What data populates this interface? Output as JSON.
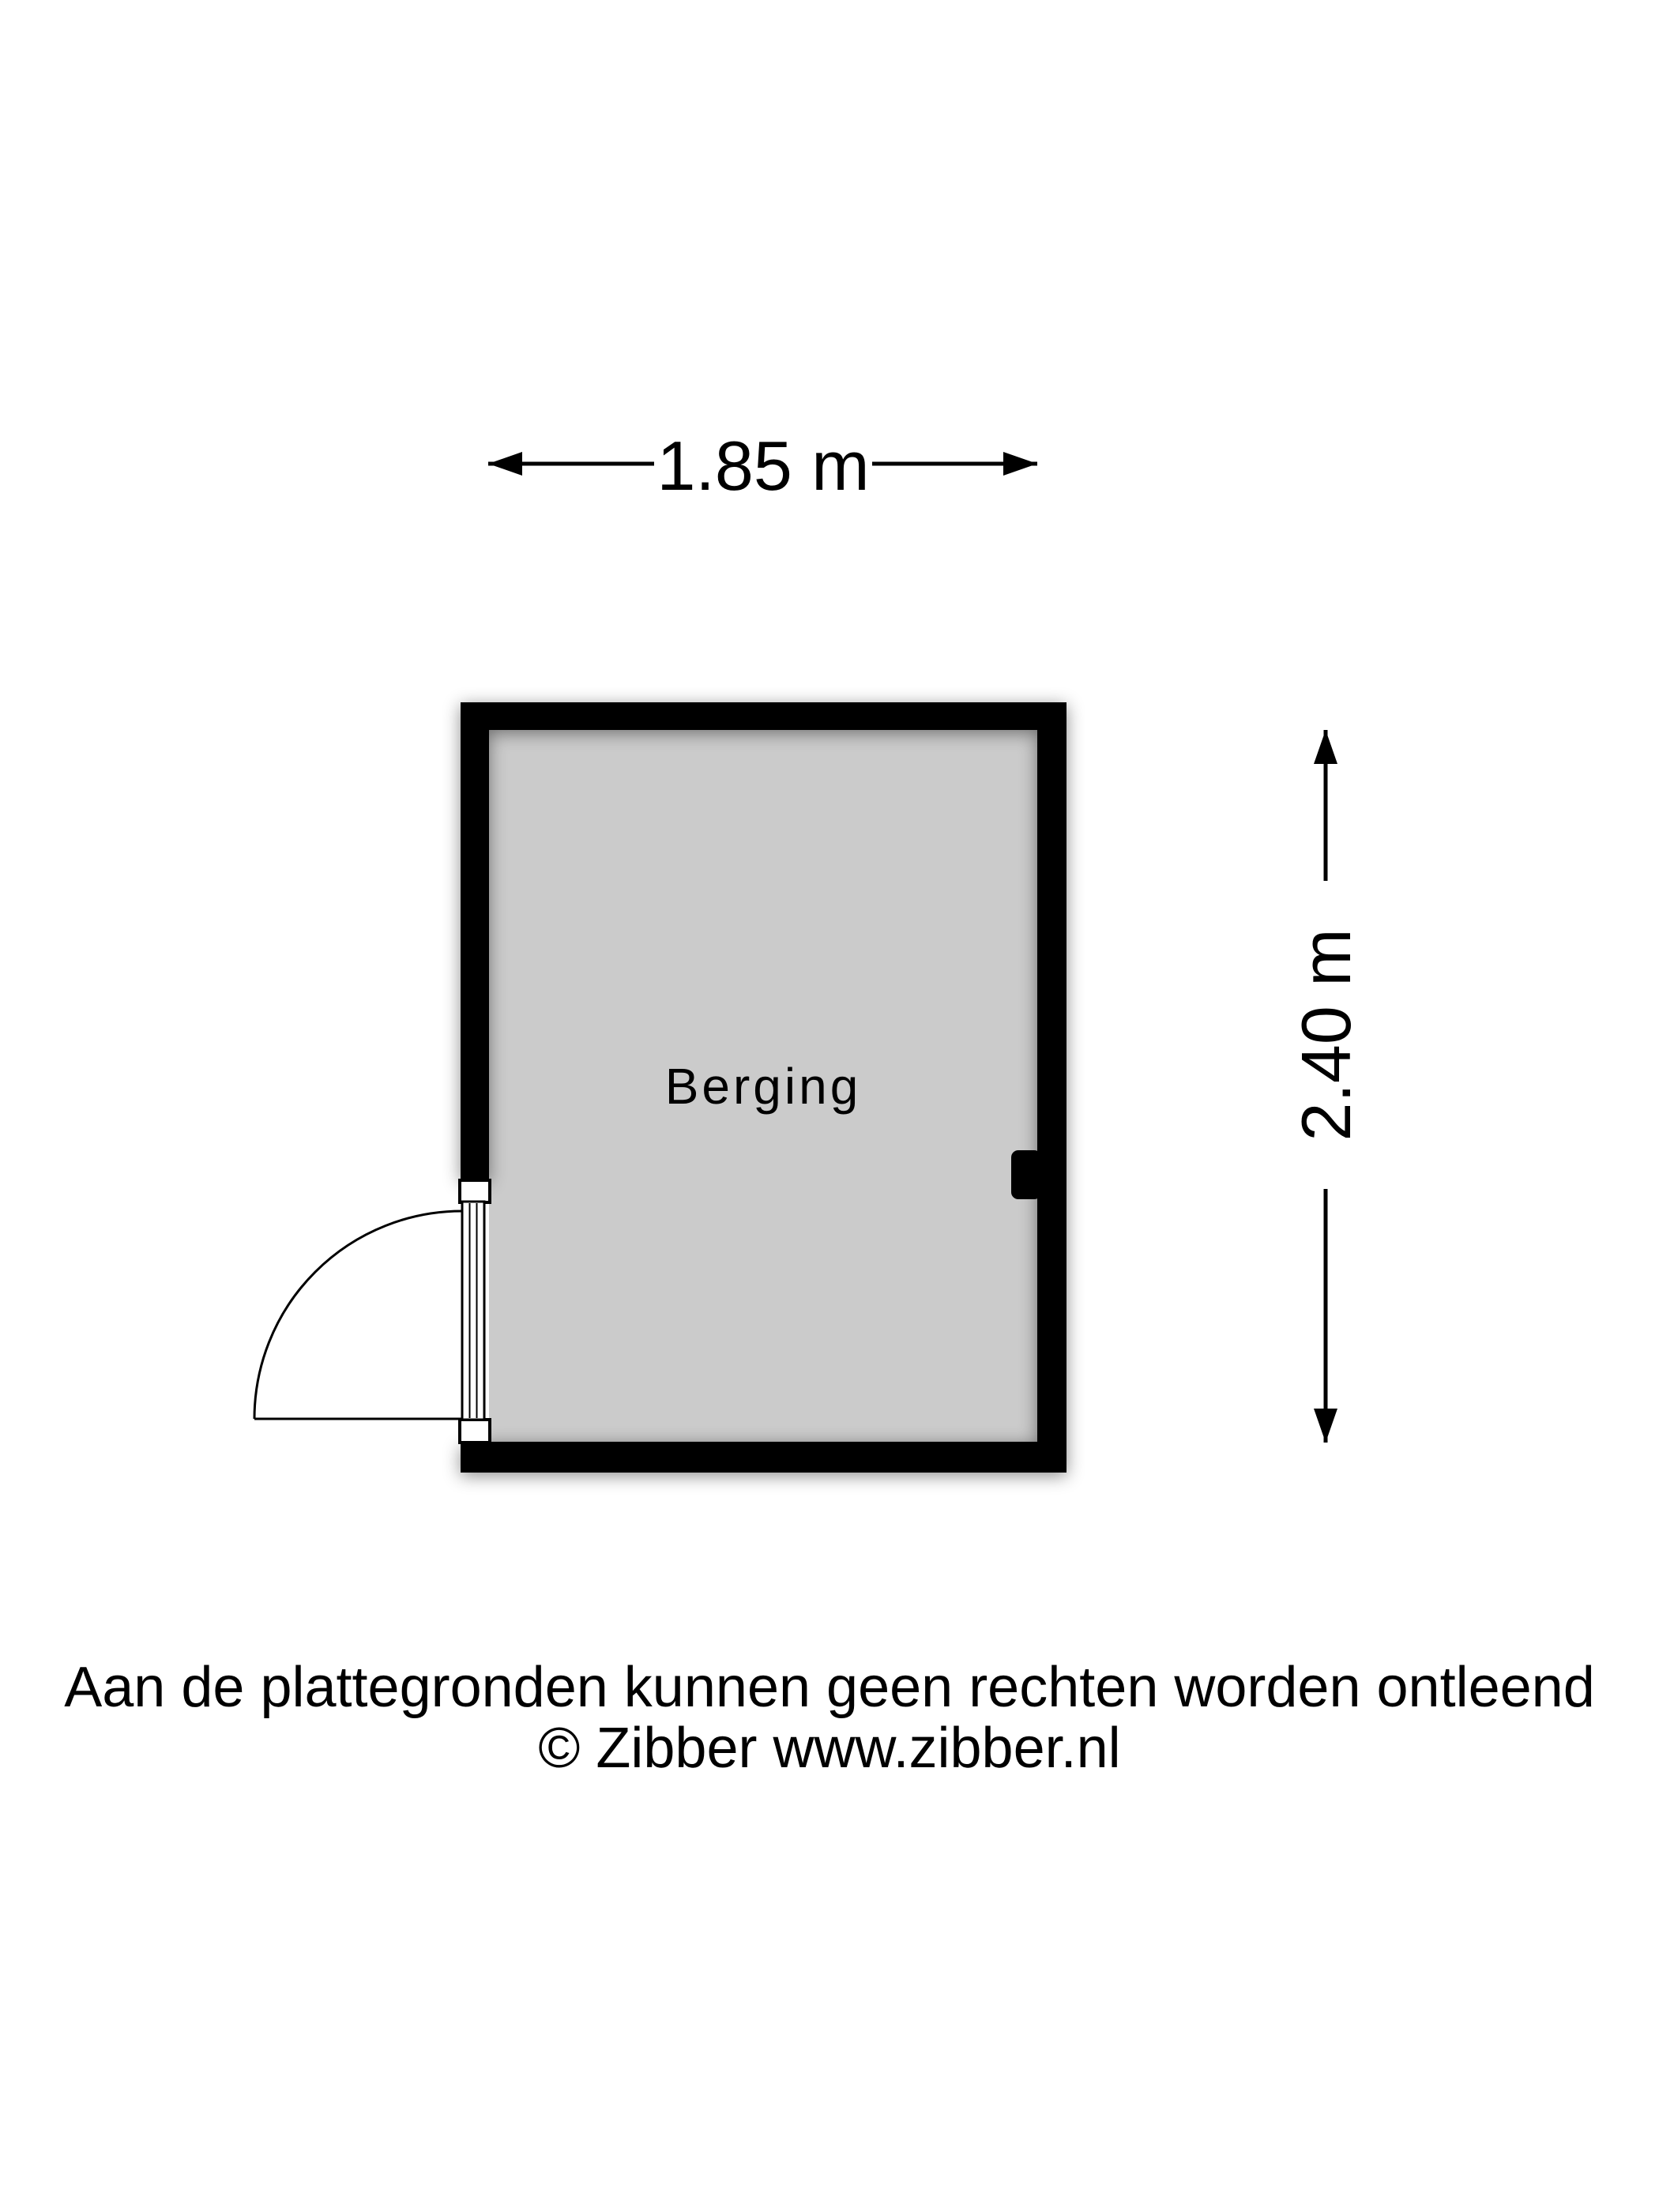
{
  "floorplan": {
    "room": {
      "label": "Berging"
    },
    "dimensions": {
      "width_label": "1.85 m",
      "height_label": "2.40 m"
    }
  },
  "footer": {
    "disclaimer": "Aan de plattegronden kunnen geen rechten worden ontleend",
    "copyright": "© Zibber www.zibber.nl"
  },
  "colors": {
    "wall": "#000000",
    "floor": "#cbcbcb",
    "background": "#ffffff",
    "text": "#000000"
  }
}
